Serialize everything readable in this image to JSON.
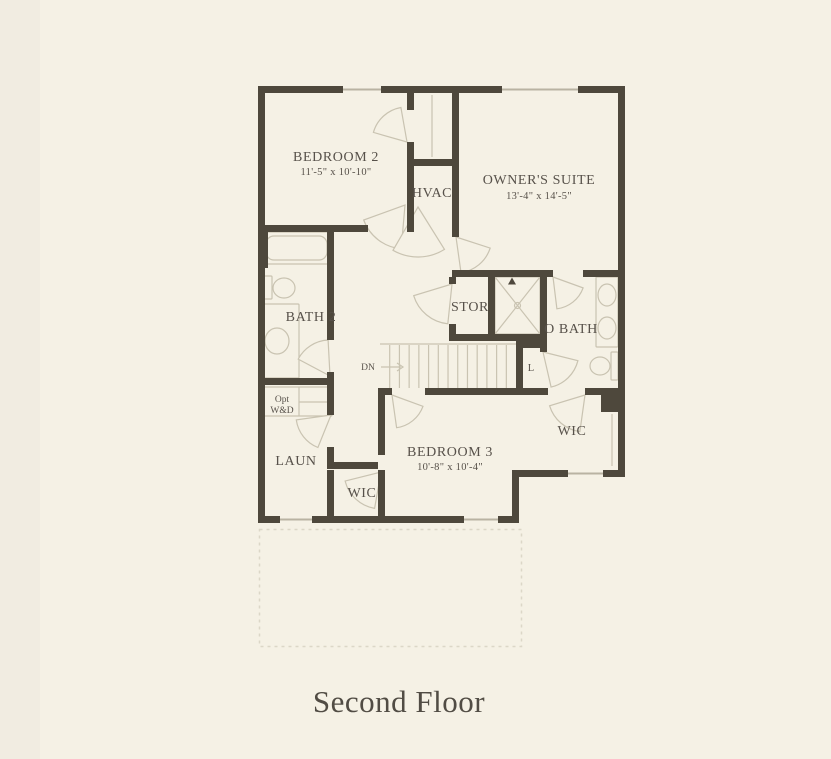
{
  "title": "Second Floor",
  "rooms": [
    {
      "id": "bedroom2",
      "label": "BEDROOM 2",
      "dims": "11'-5\" x 10'-10\""
    },
    {
      "id": "hvac",
      "label": "HVAC"
    },
    {
      "id": "owners_suite",
      "label": "OWNER'S SUITE",
      "dims": "13'-4\" x 14'-5\""
    },
    {
      "id": "bath2",
      "label": "BATH 2"
    },
    {
      "id": "stor",
      "label": "STOR"
    },
    {
      "id": "obath",
      "label": "O BATH"
    },
    {
      "id": "linen",
      "label": "L"
    },
    {
      "id": "laun",
      "label": "LAUN"
    },
    {
      "id": "wic_center",
      "label": "WIC"
    },
    {
      "id": "bedroom3",
      "label": "BEDROOM 3",
      "dims": "10'-8\" x 10'-4\""
    },
    {
      "id": "wic_right",
      "label": "WIC"
    },
    {
      "id": "opt_wd",
      "label_line1": "Opt",
      "label_line2": "W&D"
    }
  ],
  "stairs": {
    "label": "DN"
  },
  "colors": {
    "wall": "#4e483c",
    "text": "#57514a",
    "thin_line": "#c9c3b1",
    "background": "#f5f1e5",
    "background_left_strip": "#f1ece1",
    "dashed_outline": "#dcd7c7"
  }
}
